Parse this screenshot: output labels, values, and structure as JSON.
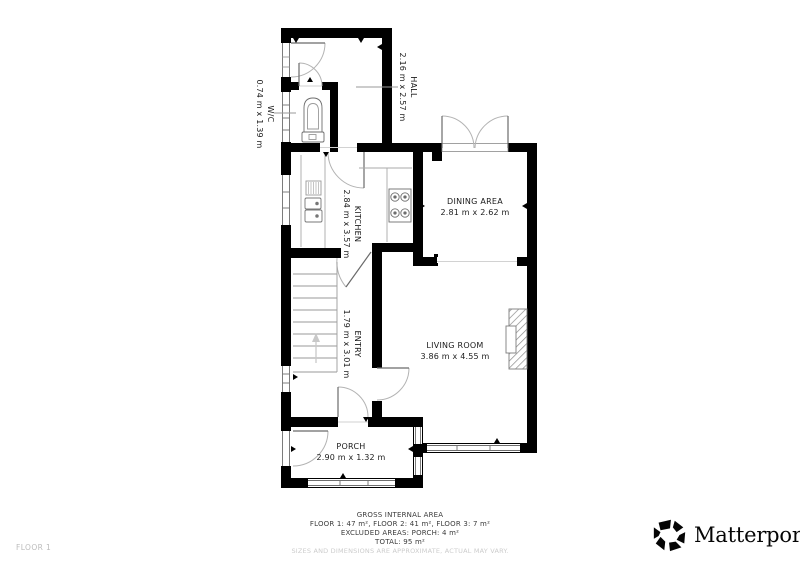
{
  "plan": {
    "rooms": {
      "hall": {
        "name": "HALL",
        "dims": "2.16 m x 2.57 m"
      },
      "wc": {
        "name": "W/C",
        "dims": "0.74 m x 1.39 m"
      },
      "kitchen": {
        "name": "KITCHEN",
        "dims": "2.84 m x 3.57 m"
      },
      "dining_area": {
        "name": "DINING AREA",
        "dims": "2.81 m x 2.62 m"
      },
      "entry": {
        "name": "ENTRY",
        "dims": "1.79 m x 3.01 m"
      },
      "living_room": {
        "name": "LIVING ROOM",
        "dims": "3.86 m x 4.55 m"
      },
      "porch": {
        "name": "PORCH",
        "dims": "2.90 m x 1.32 m"
      }
    },
    "icons": {
      "stairs": "up-arrow-icon",
      "fixtures": [
        "toilet-icon",
        "sink-icon",
        "stove-icon",
        "fireplace-icon"
      ]
    }
  },
  "footer": {
    "title": "GROSS INTERNAL AREA",
    "floors": "FLOOR 1: 47 m², FLOOR 2: 41 m², FLOOR 3: 7 m²",
    "excluded": "EXCLUDED AREAS: PORCH: 4 m²",
    "total": "TOTAL: 95 m²",
    "disclaimer": "SIZES AND DIMENSIONS ARE APPROXIMATE, ACTUAL MAY VARY."
  },
  "floor_label": "FLOOR 1",
  "branding": {
    "name": "Matterport",
    "mark": "®",
    "icon": "matterport-pinwheel-icon"
  },
  "colors": {
    "walls": "#000000",
    "background": "#ffffff",
    "thin_lines": "#9a9a9a",
    "label_text": "#1b1b1b",
    "muted_text": "#cccccc"
  }
}
